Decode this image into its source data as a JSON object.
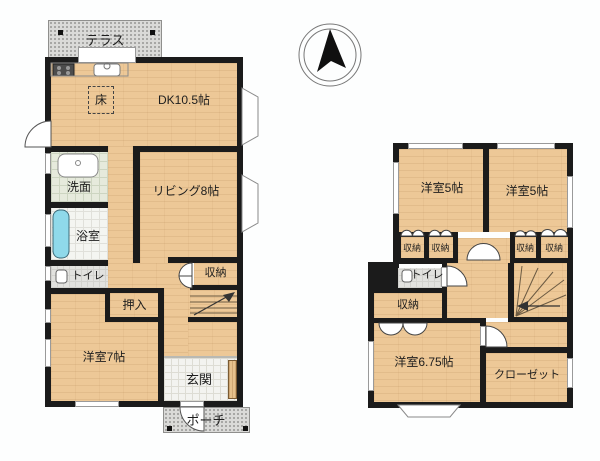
{
  "compass": {
    "icon": "north-arrow"
  },
  "floor1": {
    "terrace": "テラス",
    "floor_hatch": "床",
    "dk": "DK10.5帖",
    "washroom": "洗面",
    "living": "リビング8帖",
    "bath": "浴室",
    "toilet": "トイレ",
    "storage": "収納",
    "oshiire": "押入",
    "western7": "洋室7帖",
    "entrance": "玄関",
    "porch": "ポーチ"
  },
  "floor2": {
    "western5_left": "洋室5帖",
    "western5_right": "洋室5帖",
    "closets_top": [
      "収納",
      "収納",
      "収納",
      "収納"
    ],
    "toilet": "トイレ",
    "storage": "収納",
    "western675": "洋室6.75帖",
    "closet": "クローゼット"
  },
  "colors": {
    "background": "#fdfefe",
    "wall": "#1b1b1b",
    "wood_floor": "#edc897",
    "terrace_grey": "#dadad8",
    "entrance_tile": "#f3f3f0",
    "washroom_floor": "#e6eadc",
    "bathtub_blue": "#8fd9ea"
  },
  "icons": {
    "compass": "north-arrow",
    "stove": "stove-icon",
    "kitchen_sink": "sink-icon",
    "wash_basin": "basin-icon",
    "bathtub": "bathtub-icon",
    "toilet": "toilet-icon"
  }
}
